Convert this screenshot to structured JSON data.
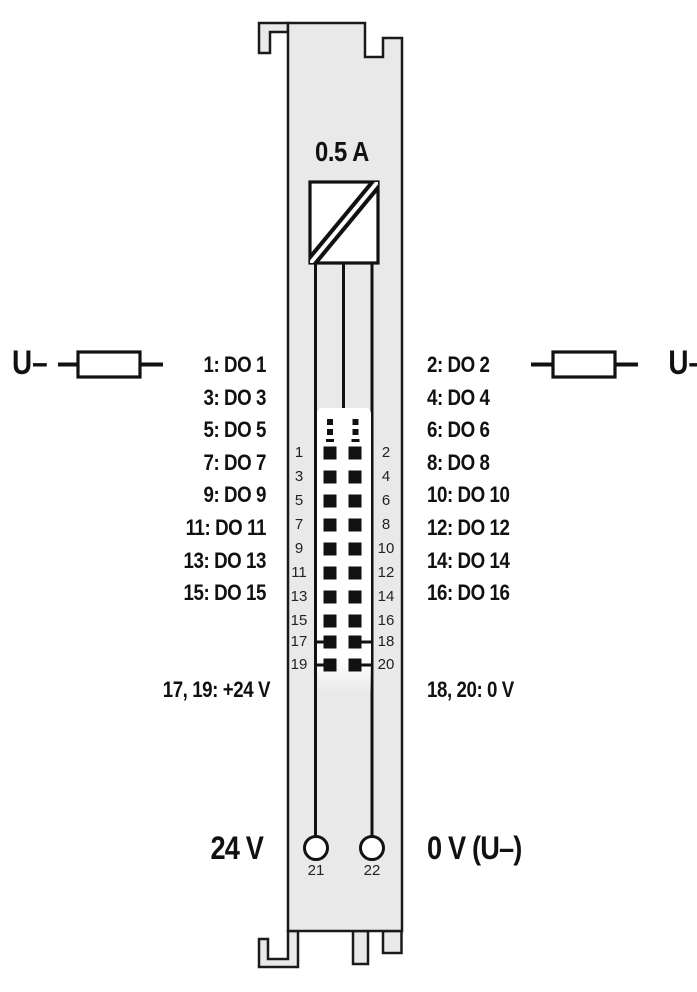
{
  "diagram": {
    "title_hint": "digital-output-module-connection-diagram",
    "fuse_rating": "0.5 A",
    "supply_left": "U–",
    "supply_right": "U–",
    "channels_left": [
      "1: DO 1",
      "3: DO 3",
      "5: DO 5",
      "7: DO 7",
      "9: DO 9",
      "11: DO 11",
      "13: DO 13",
      "15: DO 15"
    ],
    "channels_right": [
      "2: DO 2",
      "4: DO 4",
      "6: DO 6",
      "8: DO 8",
      "10: DO 10",
      "12: DO 12",
      "14: DO 14",
      "16: DO 16"
    ],
    "power_left": "17, 19: +24 V",
    "power_right": "18, 20: 0 V",
    "bottom_left": "24 V",
    "bottom_right": "0 V (U–)",
    "pins_left": [
      "1",
      "3",
      "5",
      "7",
      "9",
      "11",
      "13",
      "15",
      "17",
      "19"
    ],
    "pins_right": [
      "2",
      "4",
      "6",
      "8",
      "10",
      "12",
      "14",
      "16",
      "18",
      "20"
    ],
    "terminal_left": "21",
    "terminal_right": "22",
    "colors": {
      "module_body": "#e9e9e9",
      "outline": "#1a1a1a",
      "contact": "#111111",
      "connector_block": "#ffffff"
    }
  }
}
